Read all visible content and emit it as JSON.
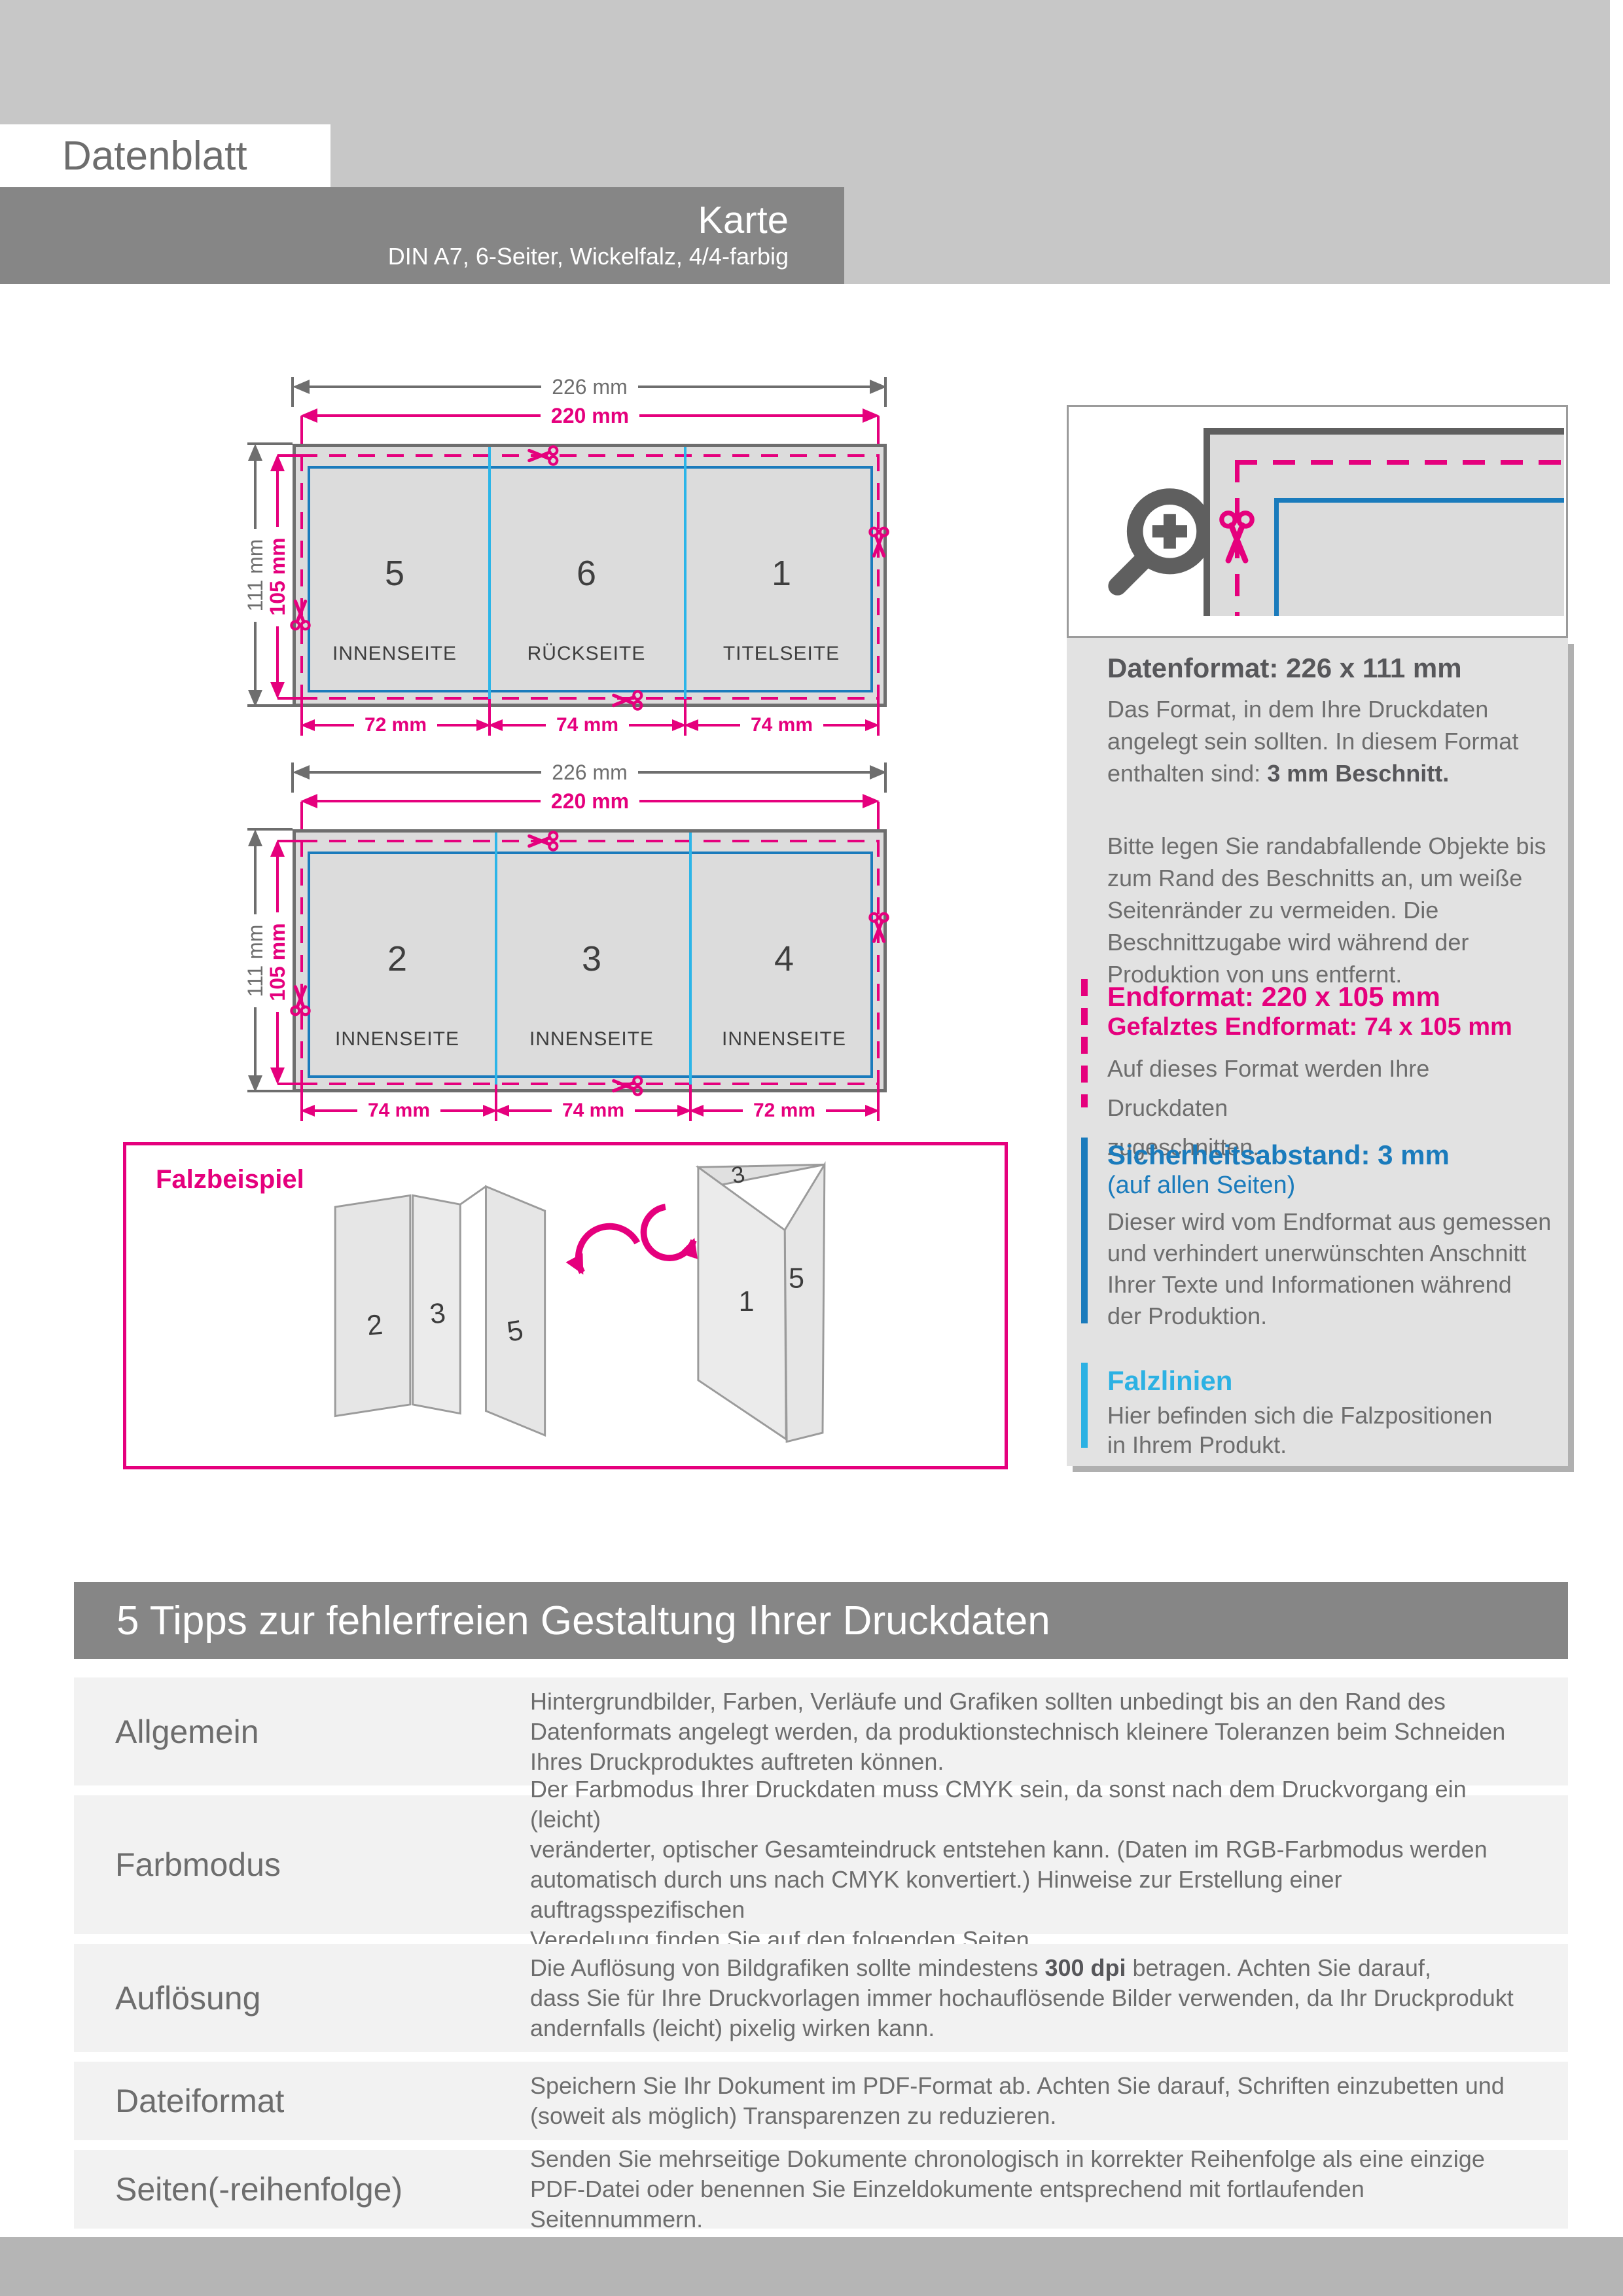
{
  "colors": {
    "magenta": "#e5007d",
    "safety_blue": "#1a7bbc",
    "fold_cyan": "#2cb5e8",
    "frame_gray": "#6e6e6e",
    "bar_gray": "#868686",
    "header_bg": "#c7c7c7",
    "row_bg": "#f2f2f2"
  },
  "header": {
    "sheet_label": "Datenblatt",
    "title": "Karte",
    "subtitle": "DIN A7, 6-Seiter, Wickelfalz, 4/4-farbig"
  },
  "diagrams": [
    {
      "total_width": "226 mm",
      "final_width": "220 mm",
      "total_height": "111 mm",
      "final_height": "105 mm",
      "panels": [
        {
          "number": "5",
          "caption": "INNENSEITE",
          "width_label": "72 mm"
        },
        {
          "number": "6",
          "caption": "RÜCKSEITE",
          "width_label": "74 mm"
        },
        {
          "number": "1",
          "caption": "TITELSEITE",
          "width_label": "74 mm"
        }
      ]
    },
    {
      "total_width": "226 mm",
      "final_width": "220 mm",
      "total_height": "111 mm",
      "final_height": "105 mm",
      "panels": [
        {
          "number": "2",
          "caption": "INNENSEITE",
          "width_label": "74 mm"
        },
        {
          "number": "3",
          "caption": "INNENSEITE",
          "width_label": "74 mm"
        },
        {
          "number": "4",
          "caption": "INNENSEITE",
          "width_label": "72 mm"
        }
      ]
    }
  ],
  "fold_example": {
    "title": "Falzbeispiel",
    "left_labels": [
      "2",
      "3",
      "5"
    ],
    "right_labels": [
      "3",
      "1",
      "5"
    ]
  },
  "sidebar": {
    "datenformat": {
      "heading": "Datenformat: 226 x 111 mm",
      "body1_pre": "Das Format, in dem Ihre Druckdaten angelegt sein sollten. In diesem Format enthalten sind: ",
      "body1_bold": "3 mm Beschnitt.",
      "body2": "Bitte legen Sie randabfallende Objekte bis\nzum Rand des Beschnitts an, um weiße\nSeitenränder zu vermeiden. Die\nBeschnittzugabe wird während der\nProduktion von uns entfernt."
    },
    "endformat": {
      "heading": "Endformat: 220 x 105 mm",
      "subheading": "Gefalztes Endformat: 74 x 105 mm",
      "body": "Auf dieses Format werden Ihre Druckdaten\nzugeschnitten."
    },
    "sicherheitsabstand": {
      "heading": "Sicherheitsabstand: 3 mm",
      "subheading": "(auf allen Seiten)",
      "body": "Dieser wird vom Endformat aus gemessen\nund verhindert unerwünschten Anschnitt\nIhrer Texte und Informationen während\nder Produktion."
    },
    "falzlinien": {
      "heading": "Falzlinien",
      "body": "Hier befinden sich die Falzpositionen\nin Ihrem Produkt."
    }
  },
  "tips": {
    "heading": "5 Tipps zur fehlerfreien Gestaltung Ihrer Druckdaten",
    "rows": [
      {
        "label": "Allgemein",
        "text": "Hintergrundbilder, Farben, Verläufe und Grafiken sollten unbedingt bis an den Rand des\nDatenformats angelegt werden, da produktionstechnisch kleinere Toleranzen beim Schneiden\nIhres Druckproduktes auftreten können."
      },
      {
        "label": "Farbmodus",
        "text": "Der Farbmodus Ihrer Druckdaten muss CMYK sein, da sonst nach dem Druckvorgang ein (leicht)\nveränderter, optischer Gesamteindruck entstehen kann. (Daten im RGB-Farbmodus werden\nautomatisch durch uns nach CMYK konvertiert.) Hinweise zur Erstellung einer auftragsspezifischen\nVeredelung finden Sie  auf den folgenden Seiten."
      },
      {
        "label": "Auflösung",
        "text_pre": "Die Auflösung von Bildgrafiken sollte mindestens ",
        "text_bold": "300 dpi",
        "text_post": " betragen. Achten Sie darauf,\ndass Sie für Ihre Druckvorlagen immer hochauflösende Bilder verwenden, da Ihr Druckprodukt\nandernfalls (leicht) pixelig wirken kann."
      },
      {
        "label": "Dateiformat",
        "text": "Speichern Sie Ihr Dokument im PDF-Format ab. Achten Sie darauf, Schriften einzubetten und\n(soweit als möglich) Transparenzen zu reduzieren."
      },
      {
        "label": "Seiten(-reihenfolge)",
        "text": "Senden Sie mehrseitige Dokumente chronologisch in korrekter Reihenfolge als eine einzige\nPDF-Datei oder benennen Sie Einzeldokumente entsprechend mit fortlaufenden Seitennummern."
      }
    ]
  }
}
